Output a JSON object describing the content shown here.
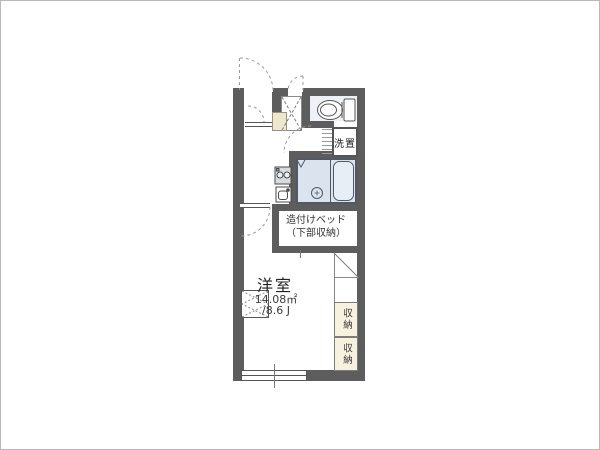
{
  "plan": {
    "type": "apartment-floor-plan",
    "rooms": {
      "main_room": {
        "name": "洋室",
        "area_m2": "14.08㎡",
        "area_jo": "/8.6 J"
      },
      "built_in_bed": {
        "line1": "造付けベッド",
        "line2": "（下部収納）"
      },
      "laundry_space": {
        "label": "洗置"
      },
      "storage_upper": {
        "label": "収納"
      },
      "storage_lower": {
        "label": "収納"
      },
      "toilet": {
        "fixture": "toilet"
      },
      "bathroom": {
        "fixtures": [
          "bathtub",
          "shower-drain"
        ]
      },
      "kitchen": {
        "fixtures": [
          "two-burner-stove",
          "sink"
        ]
      }
    },
    "icons": [
      "toilet-icon",
      "bathtub-icon",
      "shower-drain-icon",
      "stove-icon",
      "sink-icon",
      "entry-door-arc",
      "interior-door-arc",
      "window-symbol"
    ],
    "colors": {
      "wall": "#5d5d5d",
      "bath_floor": "#dbe4ee",
      "toilet_floor": "#eef2f8",
      "storage_fill": "#f7f2e0",
      "genkan_cabinet": "#efe7cb",
      "background": "#ffffff",
      "line": "#555555"
    }
  }
}
